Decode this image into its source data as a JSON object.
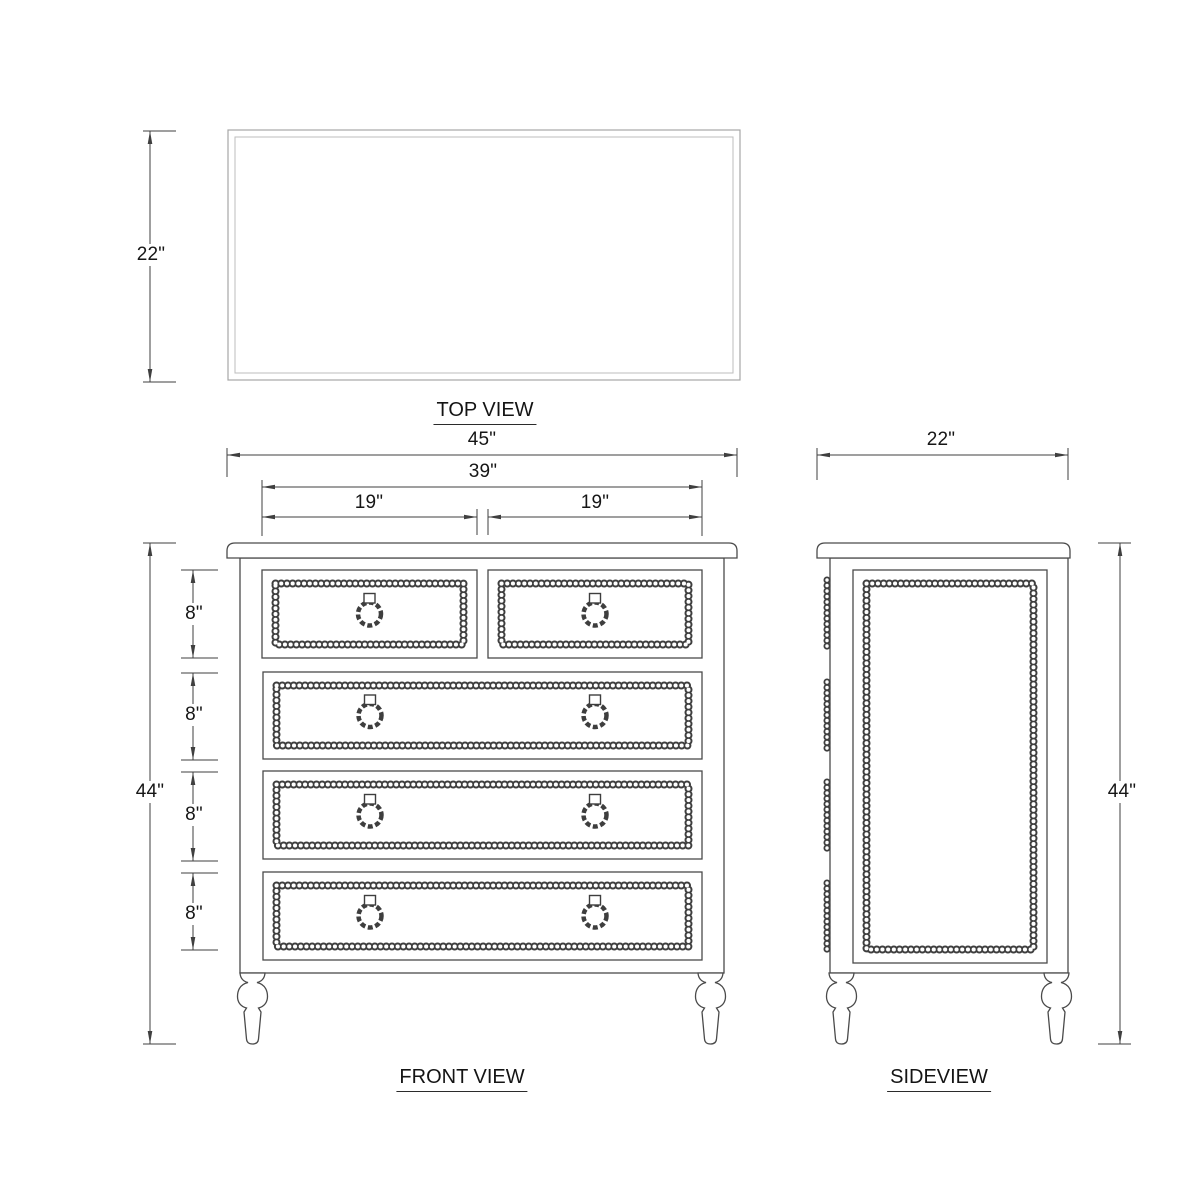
{
  "drawing": {
    "background_color": "#ffffff",
    "line_color": "#4a4a4a",
    "dimension_color": "#3f3f3f",
    "top_view": {
      "title": "TOP VIEW",
      "depth_dim": "22\""
    },
    "front_view": {
      "title": "FRONT VIEW",
      "overall_width_dim": "45\"",
      "drawer_span_dim": "39\"",
      "left_drawer_dim": "19\"",
      "right_drawer_dim": "19\"",
      "overall_height_dim": "44\"",
      "drawer_height_dims": [
        "8\"",
        "8\"",
        "8\"",
        "8\""
      ],
      "drawer_rows": 4,
      "top_row_drawers": 2
    },
    "side_view": {
      "title": "SIDEVIEW",
      "depth_dim": "22\"",
      "overall_height_dim": "44\""
    }
  }
}
